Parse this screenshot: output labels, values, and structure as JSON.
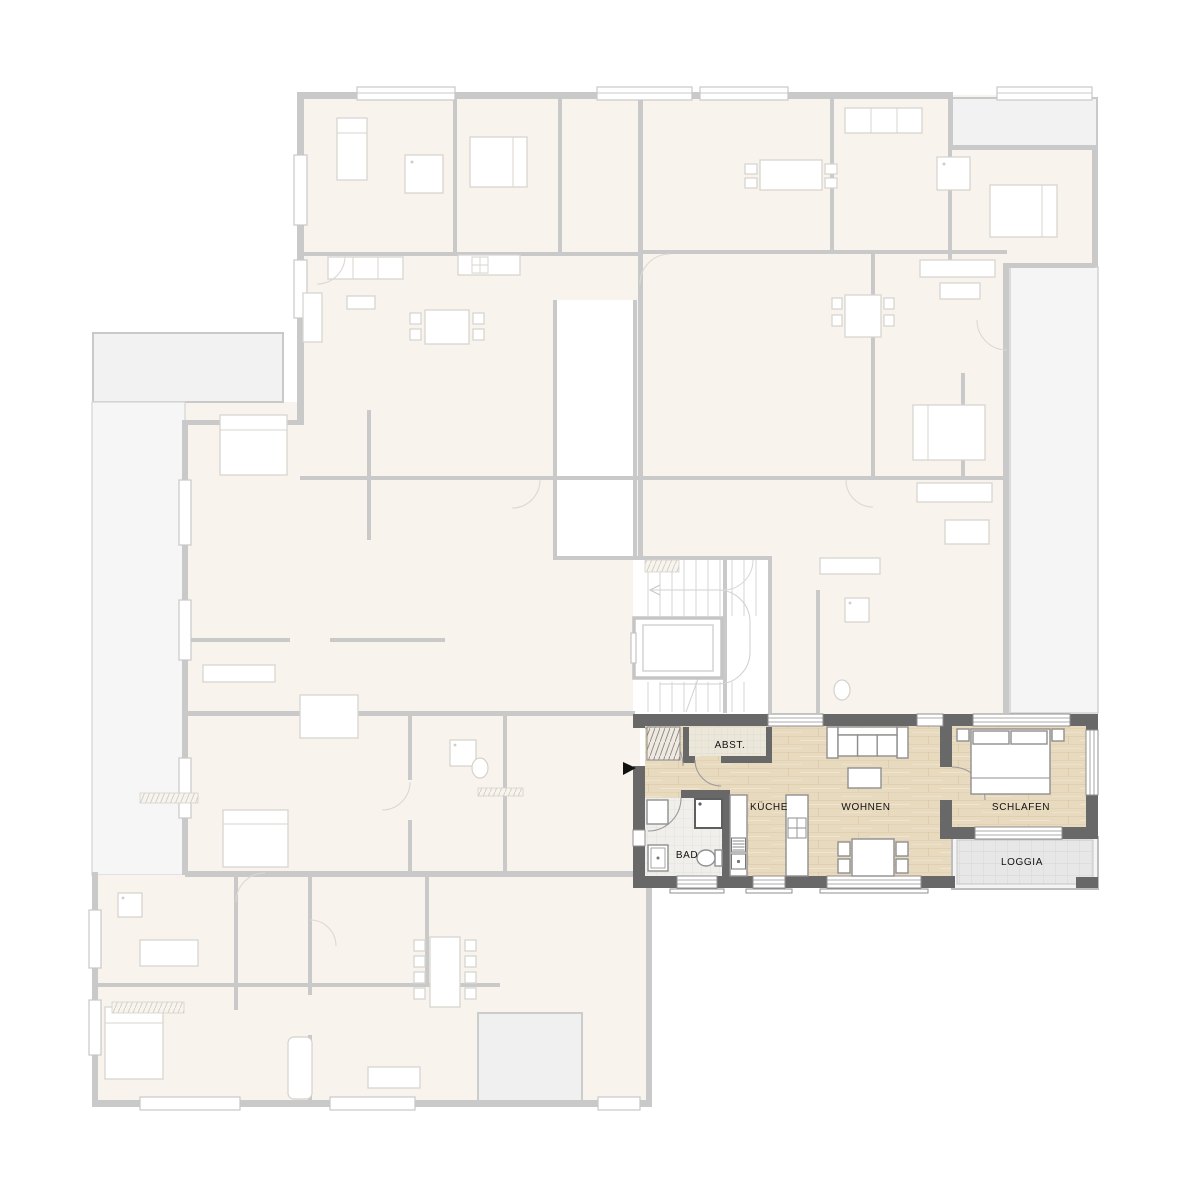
{
  "plan": {
    "title": "apartment-floor-plan",
    "highlighted_unit": {
      "rooms": [
        {
          "id": "abst",
          "label": "ABST."
        },
        {
          "id": "kueche",
          "label": "KÜCHE"
        },
        {
          "id": "wohnen",
          "label": "WOHNEN"
        },
        {
          "id": "schlafen",
          "label": "SCHLAFEN"
        },
        {
          "id": "bad",
          "label": "BAD"
        },
        {
          "id": "loggia",
          "label": "LOGGIA"
        }
      ],
      "entrance_marker": "black-triangle-arrow-right",
      "furniture": [
        "wardrobe",
        "sofa",
        "coffee-table",
        "dining-table-4-chairs",
        "kitchen-island",
        "kitchen-counter",
        "shower",
        "sink",
        "toilet",
        "double-bed",
        "nightstands"
      ]
    },
    "faded_building": {
      "features": [
        "stairwell",
        "elevator",
        "neighbor-apartments",
        "terraces",
        "balconies",
        "windows"
      ]
    },
    "palette": {
      "background": "#ffffff",
      "highlight_wall": "#686868",
      "wood_floor": "#e8dabf",
      "bad_tile_floor": "#f1efec",
      "abst_floor": "#ece7db",
      "loggia_floor": "#e7e7e7",
      "loggia_wall": "#bdbdbd",
      "faded_wall": "#c9c9c9",
      "faded_floor": "#f8f3ec",
      "terrace_floor": "#f2f2f2",
      "label_color": "#111111"
    }
  }
}
